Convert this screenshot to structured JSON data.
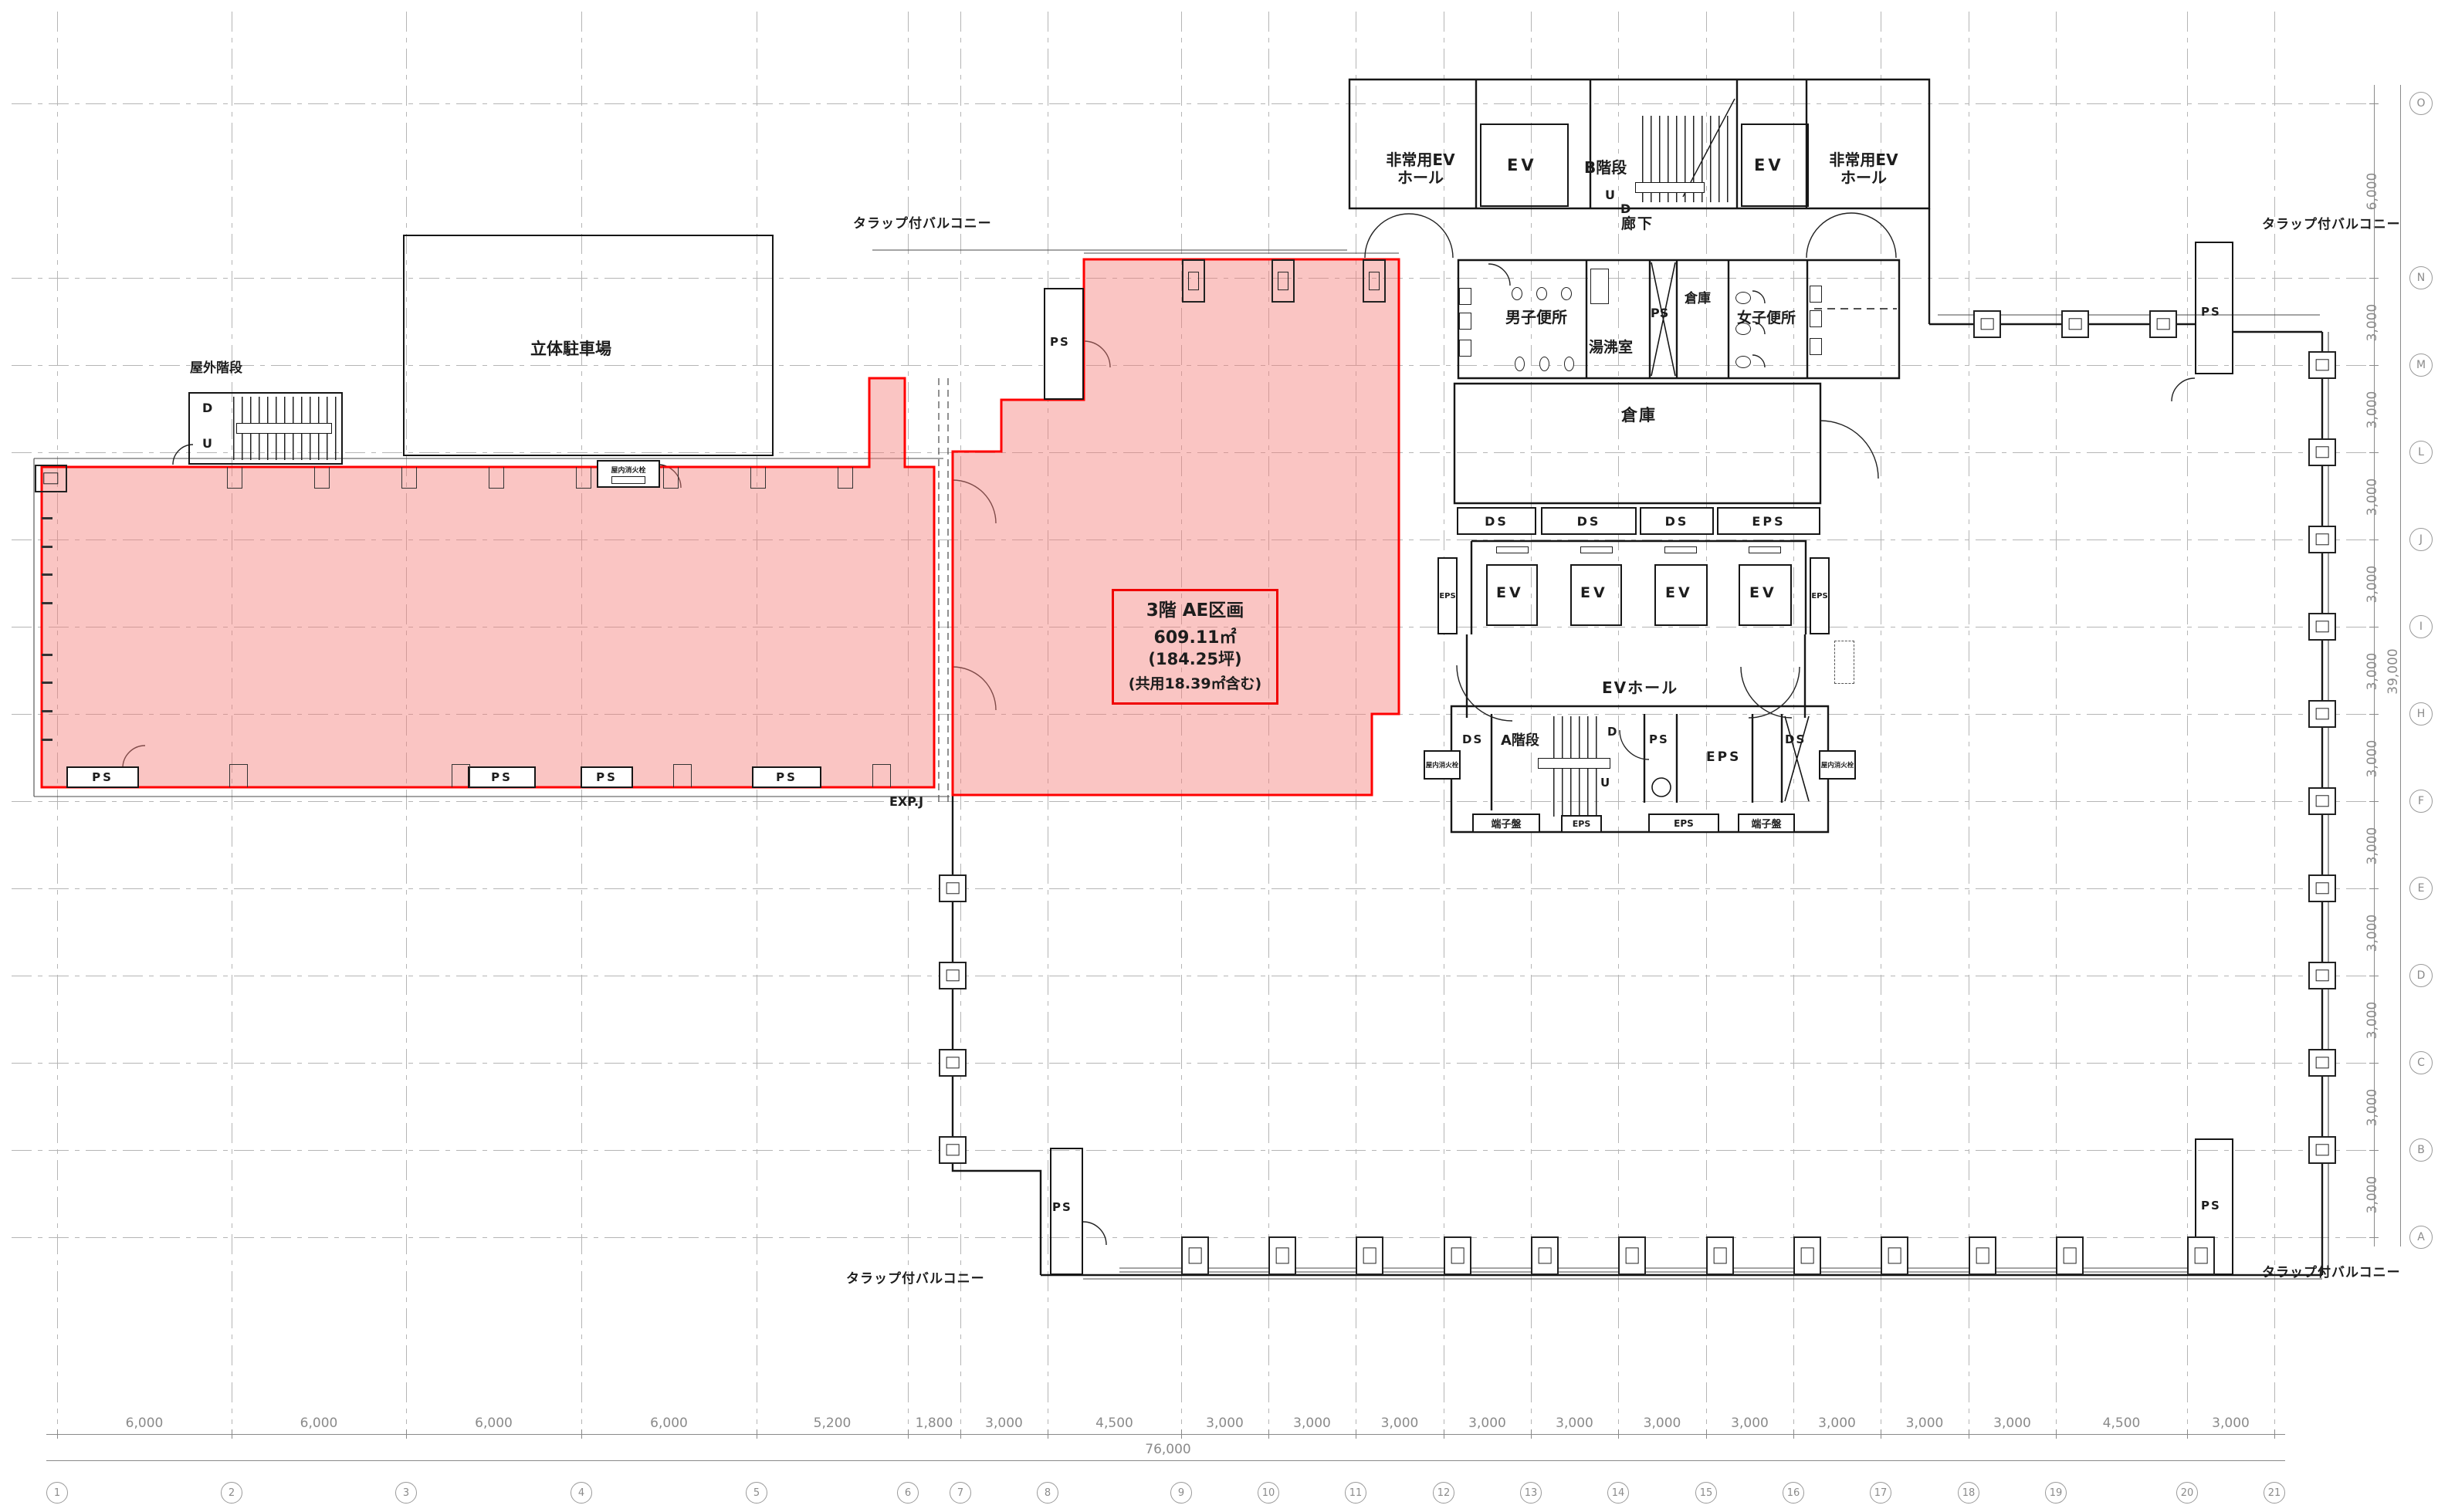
{
  "parcel": {
    "title": "3階 AE区画",
    "area": "609.11㎡",
    "area_tsubo": "(184.25坪)",
    "common_note": "(共用18.39㎡含む)"
  },
  "labels": {
    "balcony": "タラップ付バルコニー",
    "parking": "立体駐車場",
    "outdoor_stair": "屋外階段",
    "corridor": "廊下",
    "mens_wc": "男子便所",
    "womens_wc": "女子便所",
    "kitchenette": "湯沸室",
    "storage": "倉庫",
    "ev": "EV",
    "ev_hall": "EVホール",
    "emergency_ev_line1": "非常用EV",
    "emergency_ev_line2": "ホール",
    "stair_a": "A階段",
    "stair_b": "B階段",
    "up": "U",
    "down": "D",
    "ps": "PS",
    "ds": "DS",
    "eps": "EPS",
    "terminal_board": "端子盤",
    "fire_hydrant": "屋内消火栓",
    "exp_joint": "EXP.J"
  },
  "grid": {
    "columns": [
      "1",
      "2",
      "3",
      "4",
      "5",
      "6",
      "7",
      "8",
      "9",
      "10",
      "11",
      "12",
      "13",
      "14",
      "15",
      "16",
      "17",
      "18",
      "19",
      "20",
      "21"
    ],
    "rows": [
      "O",
      "N",
      "M",
      "L",
      "J",
      "I",
      "H",
      "F",
      "E",
      "D",
      "C",
      "B",
      "A"
    ],
    "bottom_dims": [
      "6,000",
      "6,000",
      "6,000",
      "6,000",
      "5,200",
      "1,800",
      "3,000",
      "4,500",
      "3,000",
      "3,000",
      "3,000",
      "3,000",
      "3,000",
      "3,000",
      "3,000",
      "3,000",
      "3,000",
      "3,000",
      "4,500",
      "3,000"
    ],
    "bottom_total": "76,000",
    "right_dims": [
      "6,000",
      "3,000",
      "3,000",
      "3,000",
      "3,000",
      "3,000",
      "3,000",
      "3,000",
      "3,000",
      "3,000",
      "3,000",
      "3,000"
    ],
    "right_total": "39,000"
  },
  "colors": {
    "highlight_fill": "#f7a8a8",
    "highlight_stroke": "#ff0000",
    "wall": "#161616",
    "grid_line": "#b5b5b5",
    "dim_text": "#8a8a8a"
  }
}
